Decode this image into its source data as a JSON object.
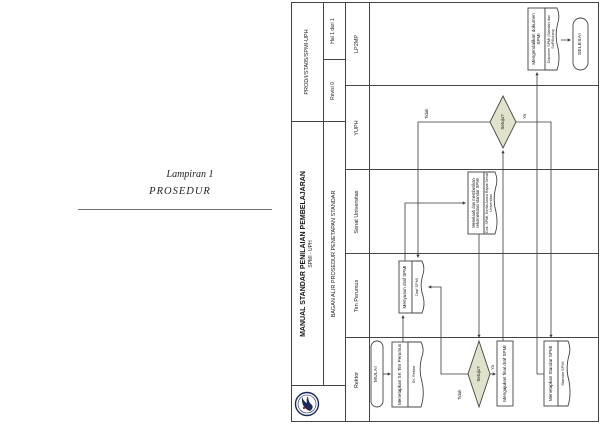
{
  "left_page": {
    "line1": "Lampiran 1",
    "line2": "PROSEDUR"
  },
  "header": {
    "title": "MANUAL STANDAR PENILAIAN PEMBELAJARAN",
    "subtitle": "SPMI - UPH",
    "doc_type": "BAGAN ALIR PROSEDUR PENETAPAN STANDAR",
    "doc_code": "PROD/I/STA05/SPMI-UPH",
    "revision": "Revisi 0",
    "page_info": "Hal 1 dari 1",
    "logo": "uph-seal-logo"
  },
  "lanes": [
    "Rektor",
    "Tim Perumus",
    "Senat Universitas",
    "YUPH",
    "LP2MP"
  ],
  "flow": {
    "start_label": "MULAI",
    "step1": {
      "label": "Menetapkan SK Tim Perumus",
      "doc": "SK Rektor"
    },
    "step2": {
      "label": "Menyusun draf SPMI",
      "doc": "Draf SPMI"
    },
    "step3": {
      "label": "Menelaah dan memberikan rekomendasi standar SPMI",
      "doc": "Dok. SPMI, Berita Acara Rapat Senat Universitas"
    },
    "decision1": {
      "label": "Setuju?",
      "yes": "Ya",
      "no": "Tidak"
    },
    "step4": {
      "label": "Mengajukan final draf SPMI"
    },
    "decision2": {
      "label": "Setuju?",
      "yes": "Ya",
      "no": "Tidak"
    },
    "step5": {
      "label": "Menetapkan Standar SPMI",
      "doc": "Standar SPMI"
    },
    "step6": {
      "label": "Mengendalikan dokumen SPMI",
      "doc": "Dokumen SPMI (Standar) dan SoP/Borang"
    },
    "end_label": "SELESAI"
  },
  "colors": {
    "decision_fill": "#e0e2cb",
    "line": "#3a3a3a",
    "border": "#444444"
  }
}
